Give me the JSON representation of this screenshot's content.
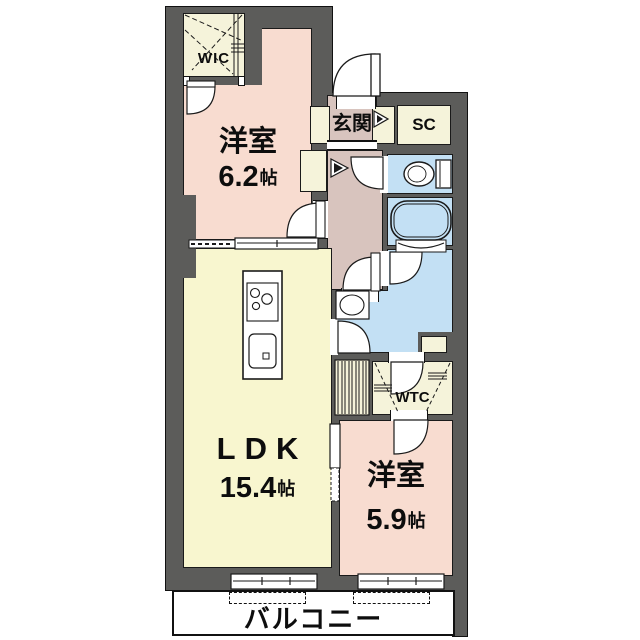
{
  "plan": {
    "title": "2LDK apartment floor plan",
    "rooms": {
      "wic": {
        "label": "WIC"
      },
      "bedroom_6_2": {
        "label": "洋室",
        "size": "6.2",
        "unit": "帖"
      },
      "entrance": {
        "label": "玄関"
      },
      "shoe_closet": {
        "label": "SC"
      },
      "ldk": {
        "label": "LDK",
        "size": "15.4",
        "unit": "帖"
      },
      "wtc": {
        "label": "WTC"
      },
      "bedroom_5_9": {
        "label": "洋室",
        "size": "5.9",
        "unit": "帖"
      },
      "balcony": {
        "label": "バルコニー"
      }
    },
    "colors": {
      "wall": "#5c5c5a",
      "bedroom": "#f8dcd0",
      "ldk": "#f8f6cf",
      "closet": "#f5f3da",
      "hall": "#d8c4be",
      "wet": "#c3e0f4",
      "outline": "#1a1a1a",
      "background": "#ffffff"
    }
  }
}
